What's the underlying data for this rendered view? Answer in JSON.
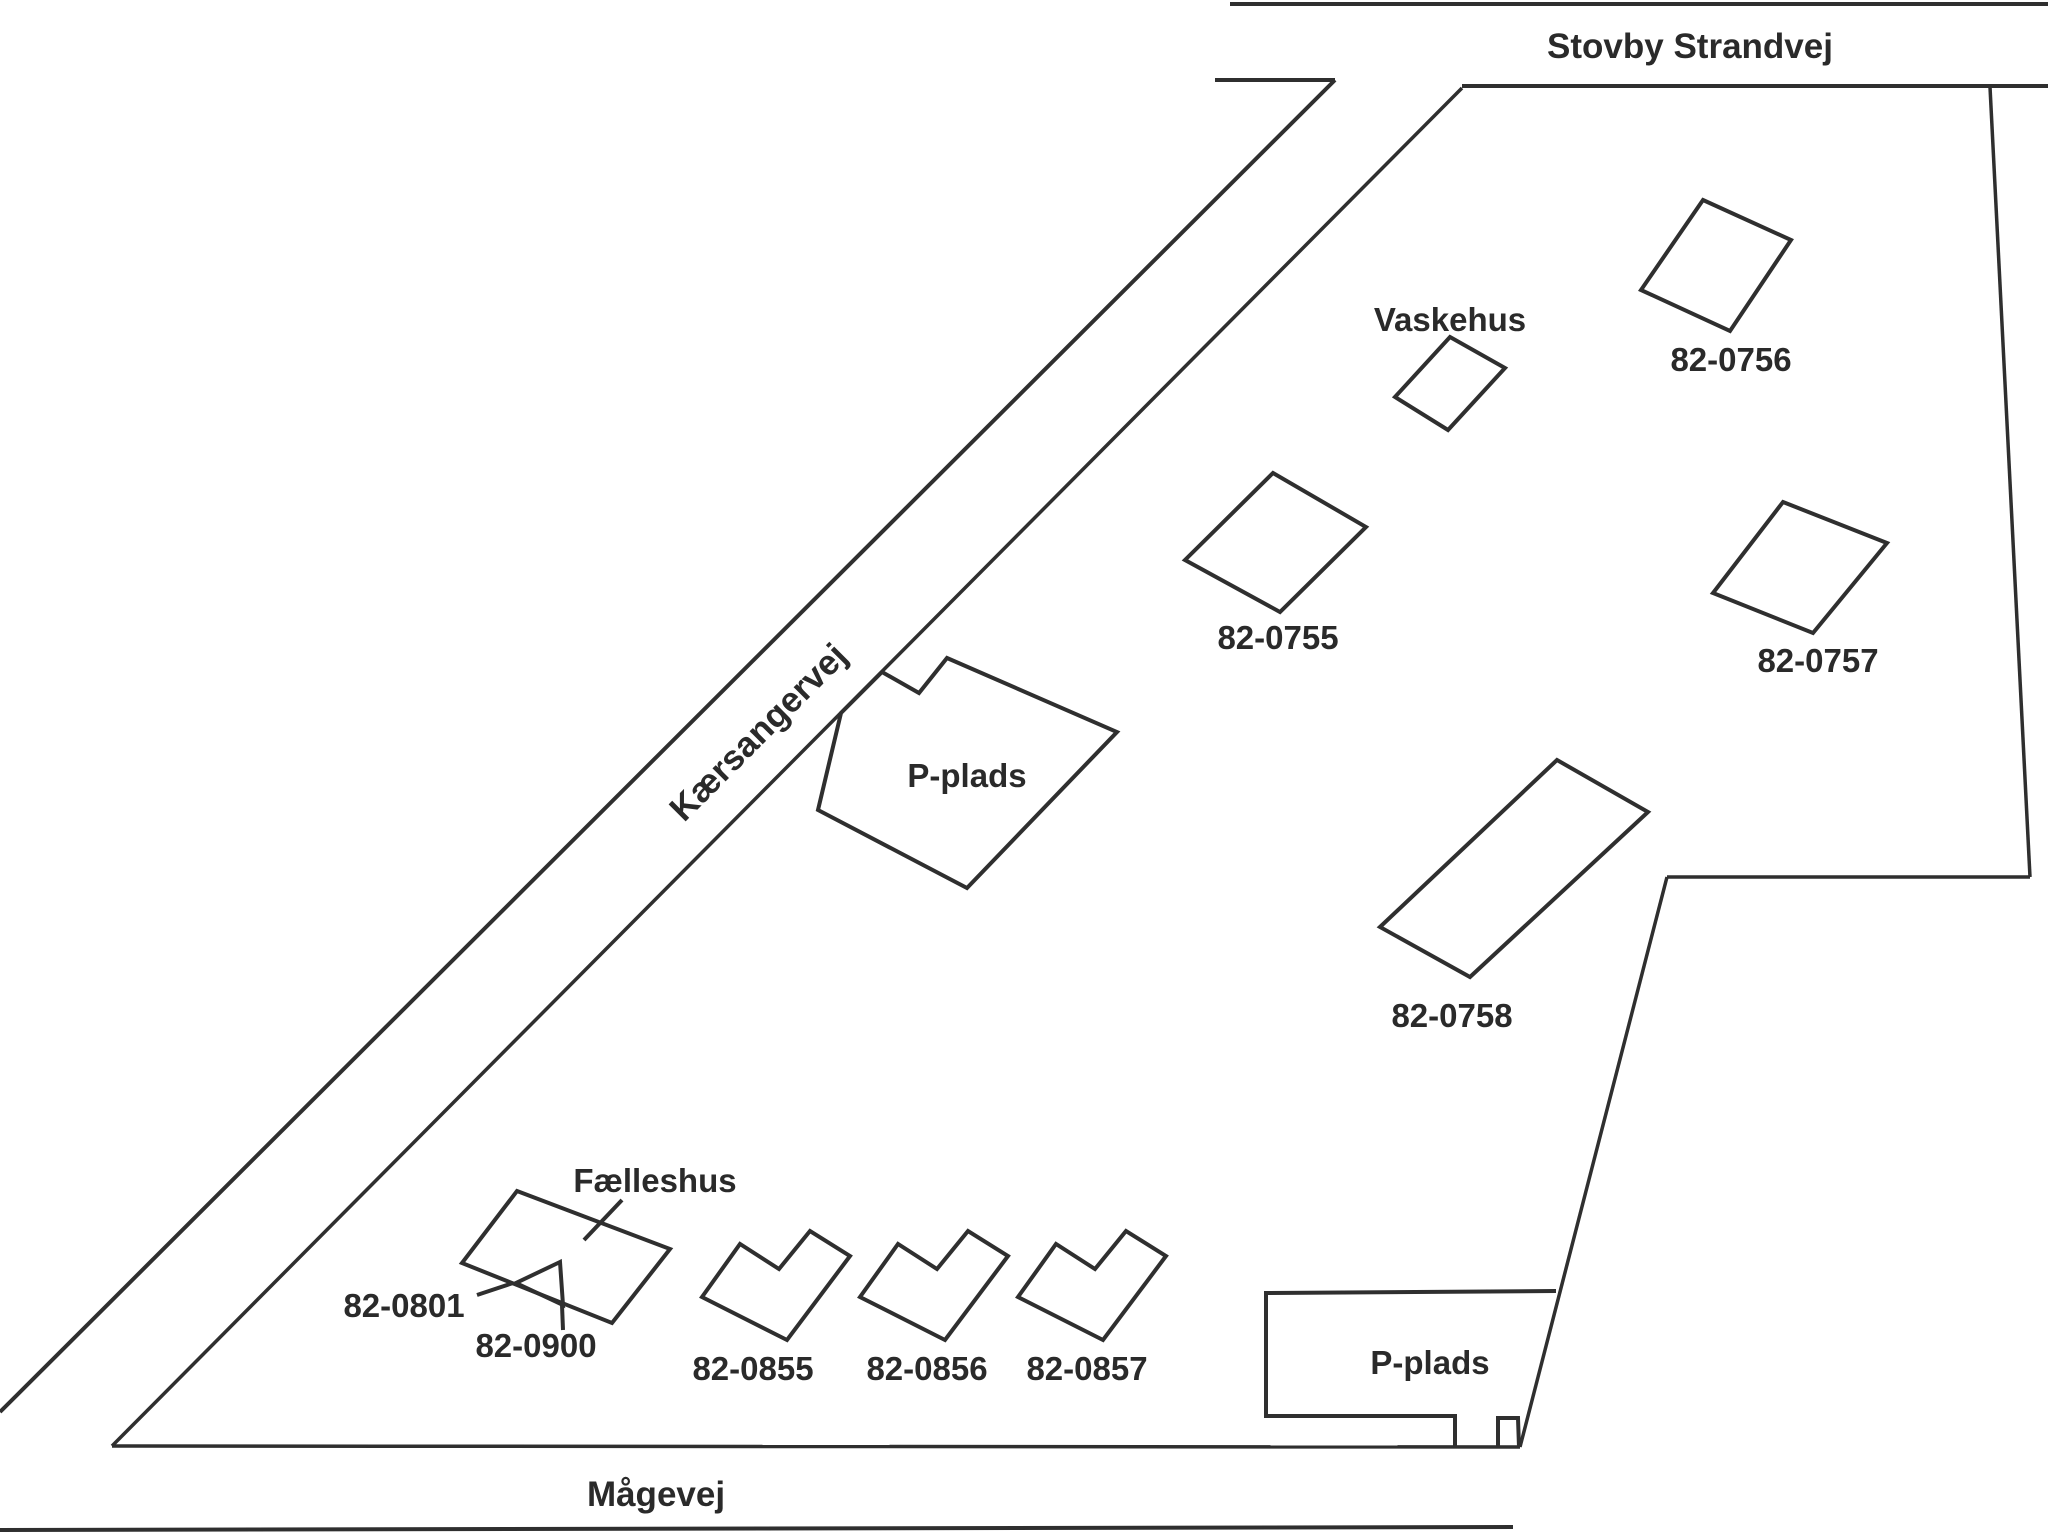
{
  "colors": {
    "background": "#ffffff",
    "line": "#2f2f2f",
    "text": "#2a2a2a"
  },
  "roads": {
    "stovby_strandvej": {
      "label": "Stovby Strandvej"
    },
    "kaersangervej": {
      "label": "Kærsangervej"
    },
    "maagevej": {
      "label": "Mågevej"
    }
  },
  "facilities": {
    "vaskehus": {
      "label": "Vaskehus"
    },
    "faelleshus": {
      "label": "Fælleshus"
    },
    "p_plads_north": {
      "label": "P-plads"
    },
    "p_plads_south": {
      "label": "P-plads"
    }
  },
  "parcels": {
    "p0755": {
      "label": "82-0755"
    },
    "p0756": {
      "label": "82-0756"
    },
    "p0757": {
      "label": "82-0757"
    },
    "p0758": {
      "label": "82-0758"
    },
    "p0801": {
      "label": "82-0801"
    },
    "p0900": {
      "label": "82-0900"
    },
    "p0855": {
      "label": "82-0855"
    },
    "p0856": {
      "label": "82-0856"
    },
    "p0857": {
      "label": "82-0857"
    }
  }
}
